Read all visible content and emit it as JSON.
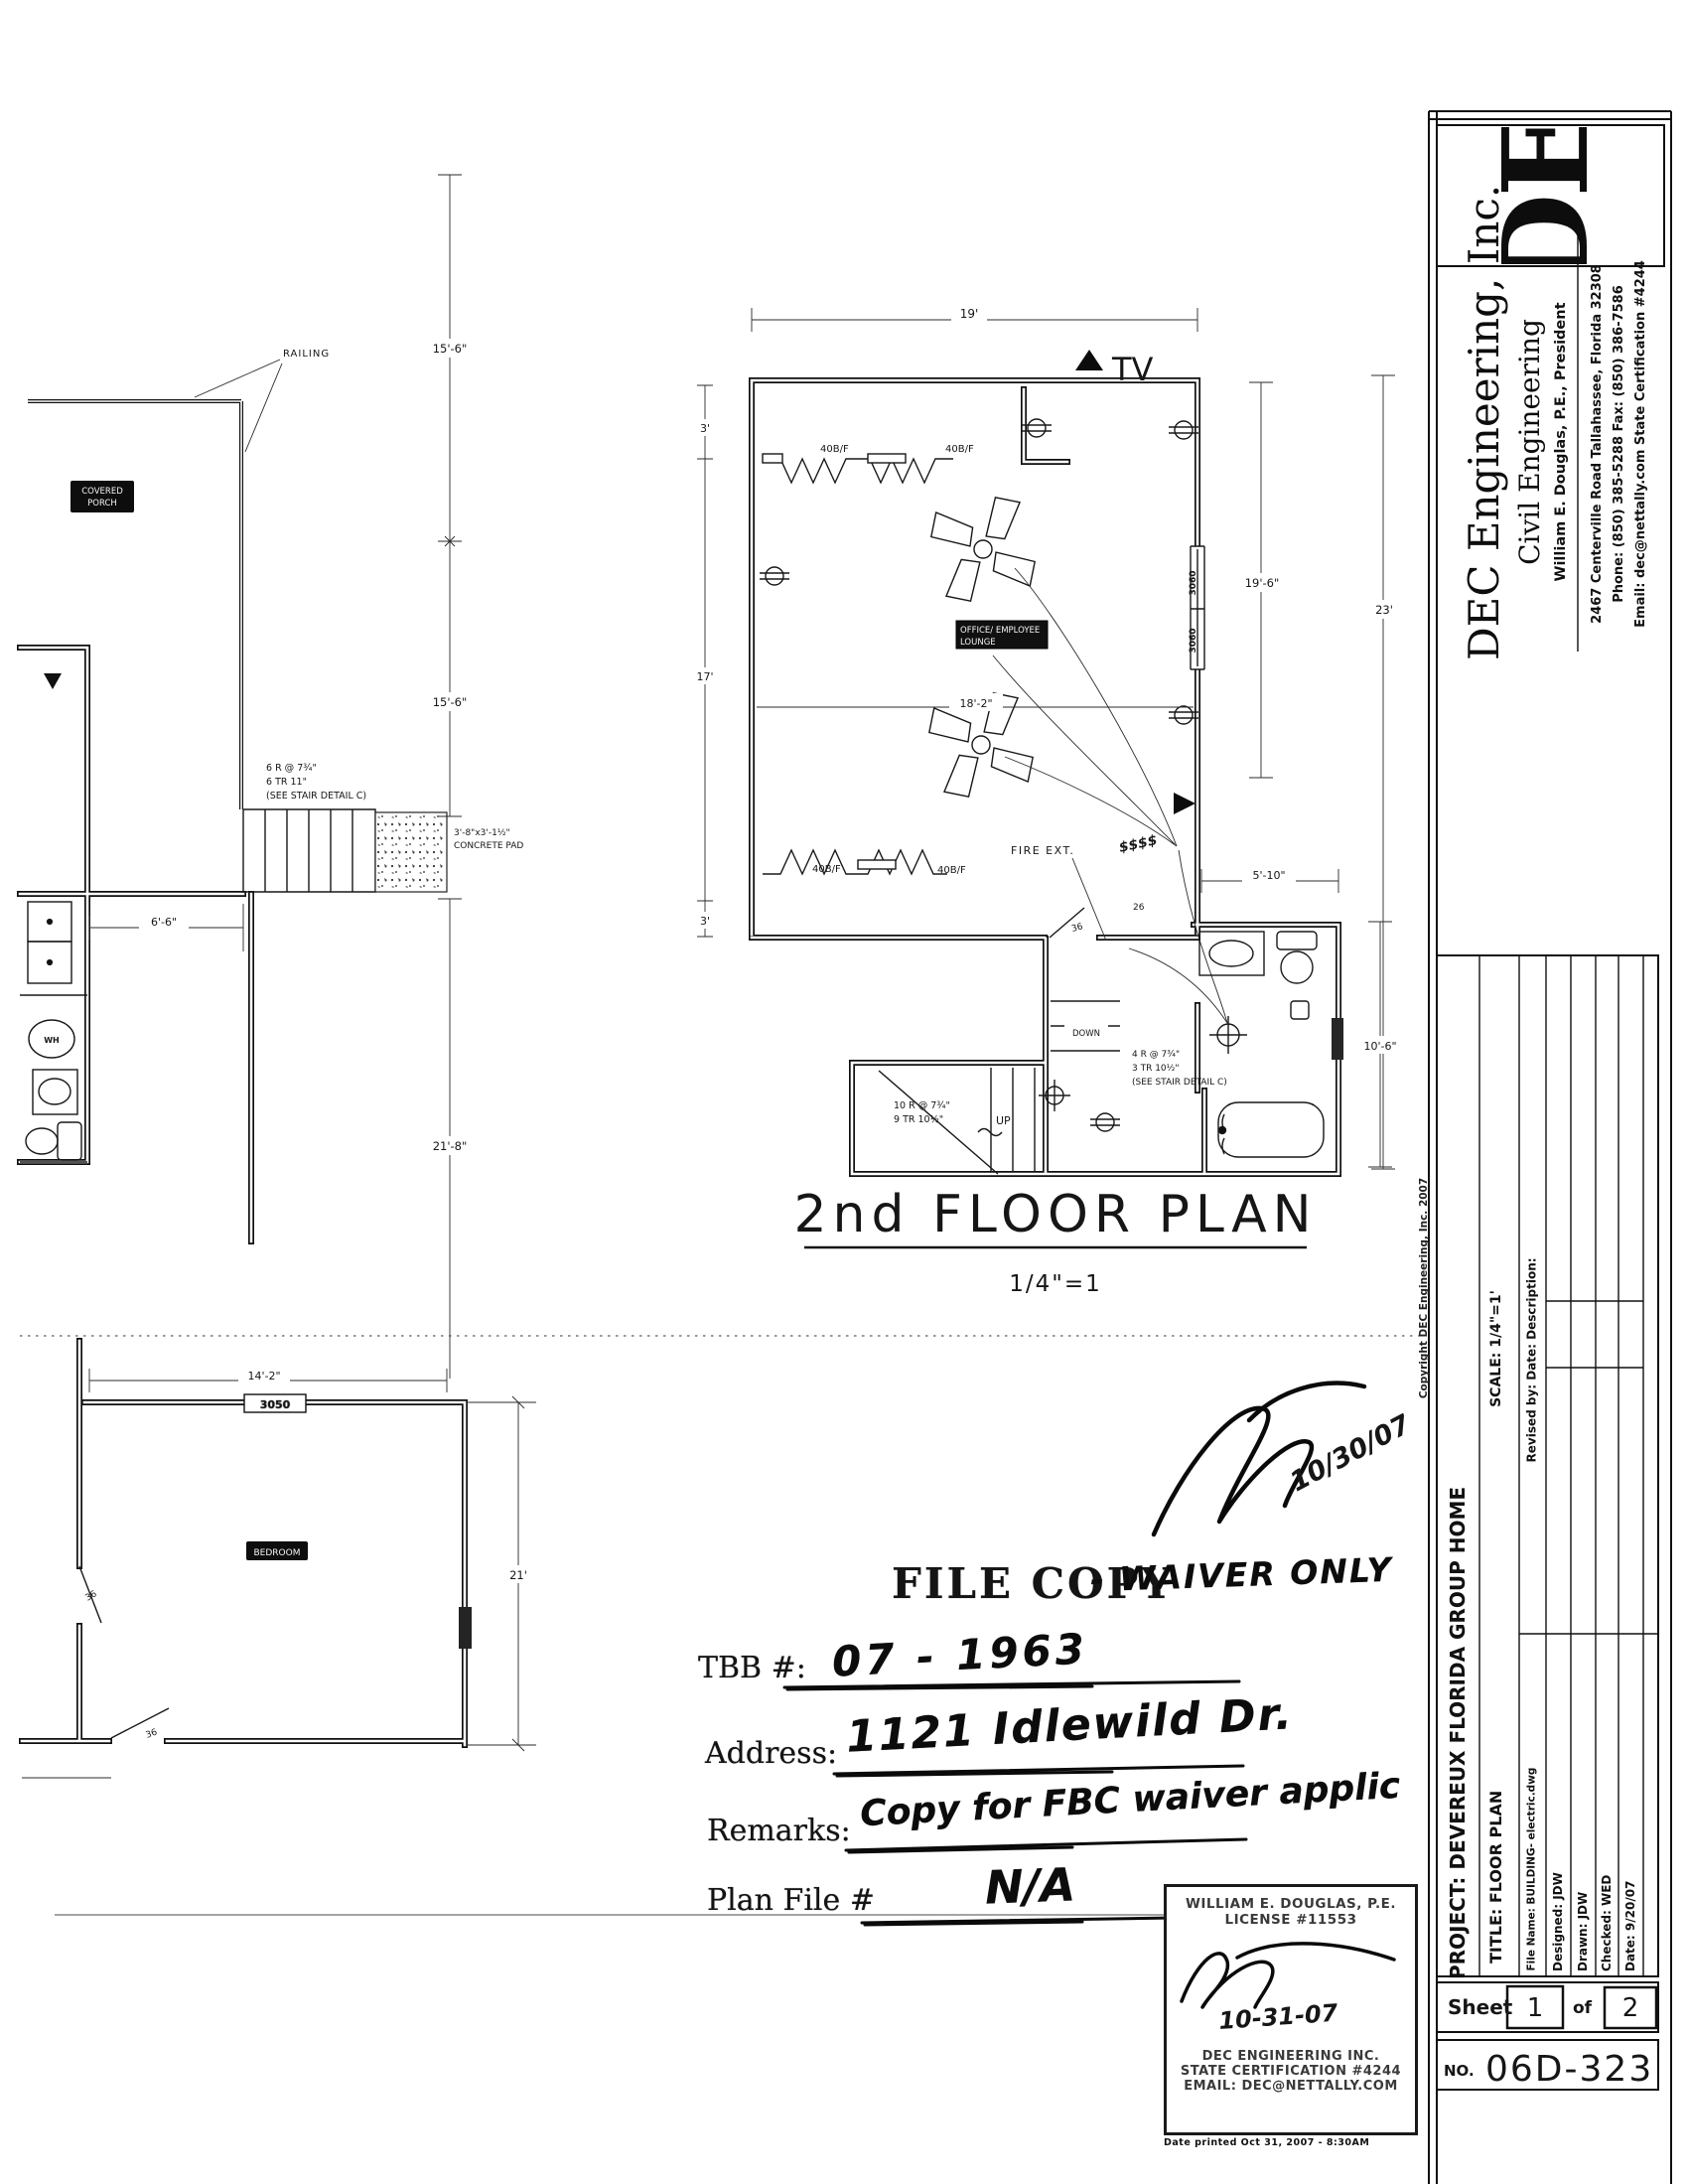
{
  "sheet": {
    "copyright_vertical": "Copyright  DEC  Engineering,  Inc.  2007",
    "printed_note": "Date printed  Oct 31, 2007  -  8:30AM"
  },
  "titleblock": {
    "logo": "DE",
    "company": "DEC Engineering, Inc.",
    "division": "Civil Engineering",
    "president": "William E. Douglas, P.E., President",
    "address_line": "2467 Centerville Road    Tallahassee, Florida 32308",
    "phone_line": "Phone: (850) 385-5288     Fax: (850) 386-7586",
    "email_line": "Email: dec@nettally.com     State Certification #4244",
    "project": "PROJECT: DEVEREUX  FLORIDA  GROUP  HOME",
    "scale": "SCALE: 1/4\"=1'",
    "revised_header": "Revised by:    Date:      Description:",
    "title": "TITLE:  FLOOR PLAN",
    "file_name": "File Name:   BUILDING-  electric.dwg",
    "designed": "Designed:      JDW",
    "drawn": "Drawn:         JDW",
    "checked": "Checked:      WED",
    "date": "Date:           9/20/07",
    "sheet_label": "Sheet",
    "sheet_number": "1",
    "of_label": "of",
    "total_sheets": "2",
    "number_label": "NO.",
    "drawing_number": "06D-323"
  },
  "stamp": {
    "name": "WILLIAM E. DOUGLAS, P.E.",
    "license": "LICENSE #11553",
    "signature_date": "10-31-07",
    "company": "DEC ENGINEERING INC.",
    "certification": "STATE CERTIFICATION #4244",
    "email": "EMAIL:  DEC@NETTALLY.COM"
  },
  "file_copy": {
    "approval_date": "10/30/07",
    "stamp_text": "FILE COPY",
    "hand_suffix": "- WAIVER ONLY",
    "tbb_label": "TBB #:",
    "tbb_value": "07 - 1963",
    "address_label": "Address:",
    "address_value": "1121 Idlewild Dr.",
    "remarks_label": "Remarks:",
    "remarks_value": "Copy for FBC waiver applic",
    "plan_file_label": "Plan File #",
    "plan_file_value": "N/A"
  },
  "plan2": {
    "title": "2nd  FLOOR  PLAN",
    "scale": "1/4\"=1",
    "room_label_1": "OFFICE/ EMPLOYEE",
    "room_label_2": "LOUNGE",
    "tv": "TV",
    "fire_ext": "FIRE EXT.",
    "up": "UP",
    "down": "DOWN",
    "smoke": "$$$$",
    "heater_label": "40B/F",
    "stair_note_a1": "10 R @ 7¾\"",
    "stair_note_a2": "9 TR 10½\"",
    "stair_note_b1": "4 R @ 7¾\"",
    "stair_note_b2": "3 TR 10½\"",
    "stair_note_b3": "(SEE STAIR DETAIL C)",
    "dims": {
      "top": "19'",
      "left_a": "3'",
      "left_b": "17'",
      "left_c": "3'",
      "interior": "18'-2\"",
      "right_inner": "19'-6\"",
      "right_outer": "23'",
      "bath_top": "5'-10\"",
      "bath_right": "10'-6\"",
      "door_a": "36",
      "door_b": "26",
      "window_tag": "3060"
    }
  },
  "plan1": {
    "railing": "RAILING",
    "porch_label_1": "COVERED",
    "porch_label_2": "PORCH",
    "bedroom_label": "BEDROOM",
    "wh": "WH",
    "window_tag": "3050",
    "stair_note_1": "6 R @ 7¾\"",
    "stair_note_2": "6 TR 11\"",
    "stair_note_3": "(SEE STAIR DETAIL C)",
    "pad_note_1": "3'-8\"x3'-1½\"",
    "pad_note_2": "CONCRETE PAD",
    "dims": {
      "porch_a": "15'-6\"",
      "porch_b": "15'-6\"",
      "entry": "6'-6\"",
      "room_h": "21'-8\"",
      "bed_w": "14'-2\"",
      "bed_h": "21'",
      "door_a": "36",
      "door_b": "36"
    }
  }
}
